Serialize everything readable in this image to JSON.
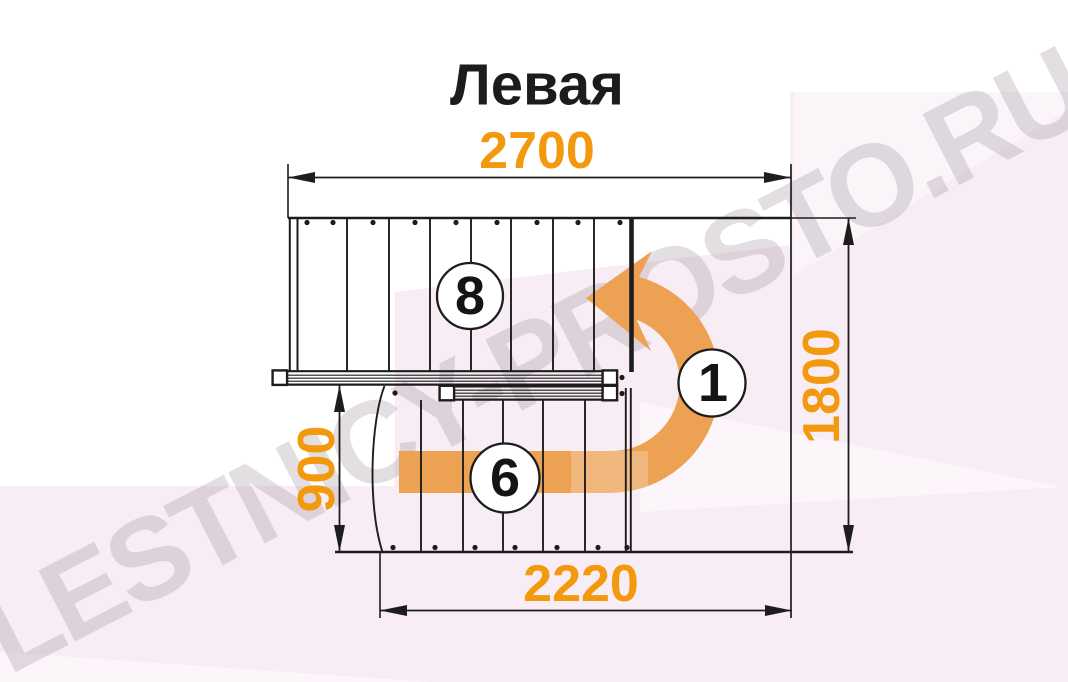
{
  "title": "Левая",
  "watermark": "LESTNICY-PROSTO.RU",
  "dimensions": {
    "upper_flight_length_mm": "2700",
    "overall_width_mm": "1800",
    "lower_flight_width_mm": "900",
    "lower_flight_length_mm": "2220"
  },
  "step_markers": {
    "upper_flight": "8",
    "turn": "1",
    "lower_flight": "6"
  },
  "colors": {
    "dimension_text": "#F2990E",
    "arrow_orange": "#EDA153",
    "drawing_line": "#1d1d1d",
    "background_tint": "#f8edf4",
    "watermark_gray": "#e7e2e7"
  }
}
